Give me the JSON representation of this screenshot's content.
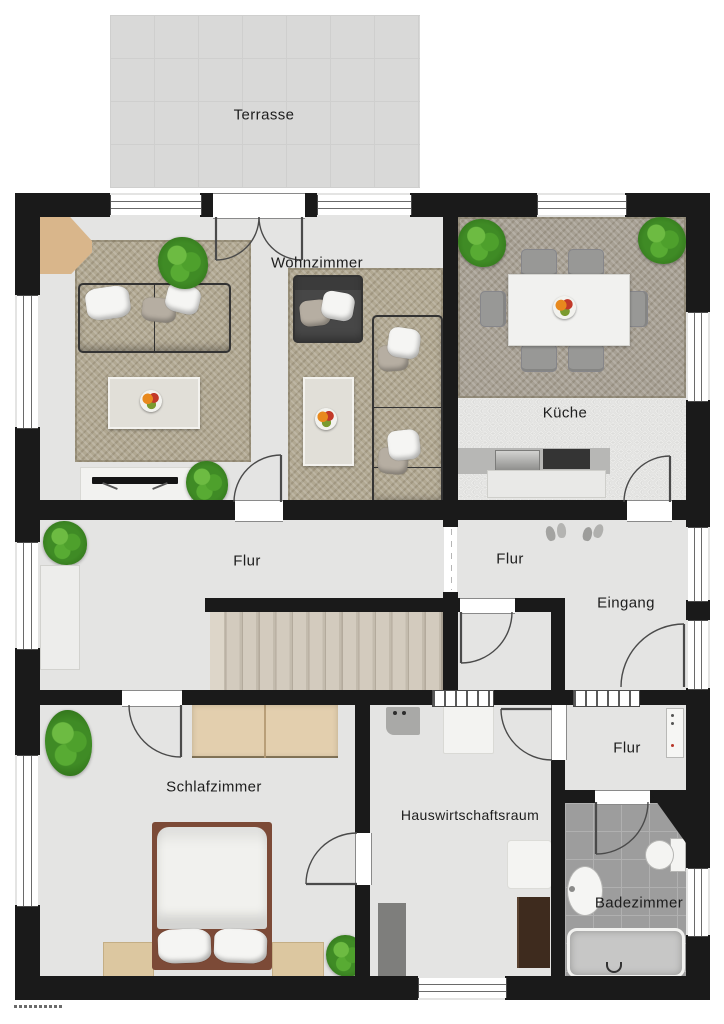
{
  "meta": {
    "document_type": "Grundriss (floor plan)",
    "language": "de"
  },
  "rooms": [
    {
      "id": "terrasse",
      "label": "Terrasse"
    },
    {
      "id": "wohnzimmer",
      "label": "Wohnzimmer"
    },
    {
      "id": "kueche",
      "label": "Küche"
    },
    {
      "id": "flur-haupt",
      "label": "Flur"
    },
    {
      "id": "flur-eingang",
      "label": "Flur"
    },
    {
      "id": "eingang",
      "label": "Eingang"
    },
    {
      "id": "flur-klein",
      "label": "Flur"
    },
    {
      "id": "schlafzimmer",
      "label": "Schlafzimmer"
    },
    {
      "id": "hauswirtschaftsraum",
      "label": "Hauswirtschaftsraum"
    },
    {
      "id": "badezimmer",
      "label": "Badezimmer"
    }
  ],
  "inventory": {
    "wohnzimmer": [
      "rug",
      "sofa",
      "armchair",
      "corner-sofa",
      "coffee-table",
      "coffee-table",
      "tv-sideboard",
      "tv",
      "side-table",
      "plant",
      "plant"
    ],
    "kueche": [
      "rug",
      "dining-table",
      "chairs-x6",
      "fruit-bowl",
      "kitchen-counter",
      "sink",
      "stove",
      "plant",
      "plant"
    ],
    "flur-haupt": [
      "sideboard",
      "plant",
      "staircase"
    ],
    "eingang": [
      "shoes",
      "front-door"
    ],
    "flur-klein": [
      "radiator"
    ],
    "schlafzimmer": [
      "double-bed",
      "wardrobe",
      "nightstand",
      "nightstand",
      "plant",
      "plant"
    ],
    "hauswirtschaftsraum": [
      "washing-machine",
      "freezer",
      "panel",
      "cabinet-dark",
      "cabinet-grey"
    ],
    "badezimmer": [
      "bathtub",
      "washbasin",
      "toilet"
    ]
  },
  "colors": {
    "wall": "#1a1a1a",
    "floor": "#e4e4e3",
    "terrace": "#d9d9d8",
    "living_rug": "#b1a892",
    "kitchen_rug": "#a7a094",
    "bath_tile": "#9d9d9d",
    "stairs": "#c9c1b4",
    "wood": "#e3cfae",
    "bed_frame": "#7c4a37",
    "sofa": "#454545",
    "plant_green": "#3f8b25"
  }
}
